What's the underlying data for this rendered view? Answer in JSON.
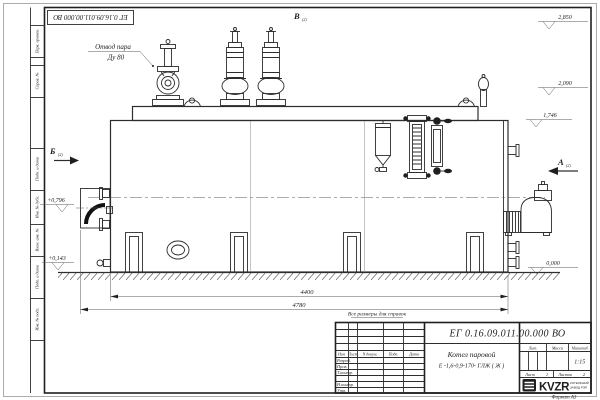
{
  "stamp_top": {
    "doc_number": "ЕГ 0.16.09.011.00.000  ВО"
  },
  "callout": {
    "line1": "Отвод пара",
    "line2": "Ду 80"
  },
  "markers": {
    "b": "Б",
    "b_ref": "(2)",
    "v": "В",
    "v_ref": "(2)",
    "a": "А",
    "a_ref": "(2)"
  },
  "elevations": {
    "e2850": "2,850",
    "e2090": "2,090",
    "e1746": "1,746",
    "e0796": "+0,796",
    "e0143": "+0,143",
    "e0000": "0,000"
  },
  "dimensions": {
    "d4400": "4400",
    "d4780": "4780"
  },
  "note": "Все размеры для справок",
  "side_column": {
    "c1": "Перв. примен.",
    "c2": "Справ. №",
    "c3": "Подп. и дата",
    "c4": "Инв. № дубл.",
    "c5": "Взам. инв. №",
    "c6": "Подп. и дата",
    "c7": "Инв. № подл."
  },
  "title_block": {
    "doc_number": "ЕГ 0.16.09.011.00.000  ВО",
    "name_line1": "Котел паровой",
    "name_line2": "Е -1,6-0,9-170- ГЛЖ ( Ж )",
    "col_izm": "Изм",
    "col_list": "Лист",
    "col_ndokum": "N докум.",
    "col_podp": "Подп.",
    "col_data": "Дата",
    "row_razrab": "Разраб.",
    "row_prov": "Пров.",
    "row_tkontr": "Т.контр.",
    "row_nkontr": "Н.контр.",
    "row_utv": "Утв.",
    "lit_header": "Лит.",
    "massa_header": "Масса",
    "masshtab_header": "Масштаб",
    "scale": "1:15",
    "list_label": "Лист",
    "list_value": "1",
    "listov_label": "Листов",
    "listov_value": "2",
    "logo_text": "KVZR",
    "logo_sub1": "КОТЕЛЬНЫЙ",
    "logo_sub2": "ЗАВОД РЭП",
    "format_label": "Формат А3"
  }
}
